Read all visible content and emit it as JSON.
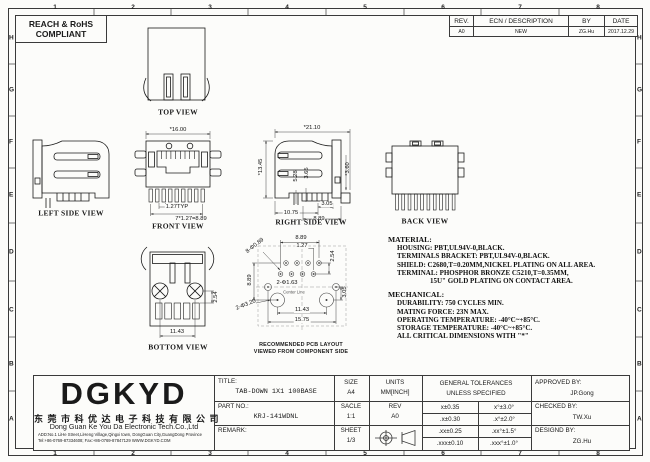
{
  "sheet": {
    "zone_cols": [
      "1",
      "2",
      "3",
      "4",
      "5",
      "6",
      "7",
      "8"
    ],
    "zone_rows": [
      "H",
      "G",
      "F",
      "E",
      "D",
      "C",
      "B",
      "A"
    ],
    "compliance_line1": "REACH & RoHS",
    "compliance_line2": "COMPLIANT"
  },
  "revision_table": {
    "col_rev": "REV.",
    "col_ecn": "ECN / DESCRIPTION",
    "col_by": "BY",
    "col_date": "DATE",
    "rev": "A0",
    "ecn": "NEW",
    "by": "ZG.Hu",
    "date": "2017.12.29"
  },
  "views": {
    "top_label": "TOP VIEW",
    "left_label": "LEFT SIDE VIEW",
    "front_label": "FRONT VIEW",
    "right_label": "RIGHT SIDE VIEW",
    "back_label": "BACK VIEW",
    "bottom_label": "BOTTOM VIEW",
    "pcb_caption1": "RECOMMENDED PCB LAYOUT",
    "pcb_caption2": "VIEWED FROM COMPONENT SIDE",
    "pcb_center_note": "Center Line"
  },
  "dims": {
    "front_width": "*16.00",
    "front_pitch": "1.27TYP",
    "front_total": "7*1.27=8.89",
    "right_width": "*21.10",
    "right_height": "*13.45",
    "right_a": "5.28",
    "right_b": "3.65",
    "right_c": "*3.60",
    "right_d": "3.05",
    "right_e": "10.75",
    "right_f": "8.89",
    "bottom_a": "2.54",
    "bottom_b": "11.43",
    "pcb_top": "8.89",
    "pcb_pitch": "1.27",
    "pcb_row": "2.54",
    "pcb_left": "8.89",
    "pcb_pin_holes": "8-Φ0.89",
    "pcb_mid_holes": "2-Φ1.63",
    "pcb_mid_offset": "3.05",
    "pcb_big_holes": "2-Φ3.20",
    "pcb_span_posts": "11.43",
    "pcb_span_holes": "15.75"
  },
  "notes": {
    "material_title": "MATERIAL:",
    "material_lines": [
      "HOUSING: PBT,UL94V-0,BLACK.",
      "TERMINALS BRACKET: PBT,UL94V-0,BLACK.",
      "SHIELD: C2680,T=0.20MM,NICKEL PLATING ON ALL AREA.",
      "TERMINAL: PHOSPHOR BRONZE C5210,T=0.35MM,",
      "15U\" GOLD PLATING ON CONTACT AREA."
    ],
    "mechanical_title": "MECHANICAL:",
    "mechanical_lines": [
      "DURABILITY: 750 CYCLES MIN.",
      "MATING FORCE: 23N MAX.",
      "OPERATING TEMPERATURE: -40°C~+85°C.",
      "STORAGE TEMPERATURE: -40°C~+85°C.",
      "ALL CRITICAL DIMENSIONS WITH \"*\""
    ]
  },
  "title_block": {
    "logo": "DGKYD",
    "company_cn": "东 莞 市 科 优 达 电 子 科 技 有 限 公 司",
    "company_en": "Dong Guan Ke You Da Electronic Tech.Co.,Ltd",
    "address": "ADD:No.1 LiHe Street,LiHeng Village,Qingxi town, DongGuan City,GuangDong Province",
    "contact": "Tel:+86-0769-87334608; Fax:+86-0769-87847129 WWW.DGKYD.COM",
    "title_label": "TITLE:",
    "title_value": "TAB-DOWN 1X1 100BASE",
    "part_label": "PART NO.:",
    "part_value": "KRJ-141WDNL",
    "remark_label": "REMARK:",
    "size_label": "SIZE",
    "size_value": "A4",
    "units_label": "UNITS",
    "units_value": "MM[INCH]",
    "scale_label": "SACLE",
    "scale_value": "1:1",
    "rev_label": "REV",
    "rev_value": "A0",
    "sheet_label": "SHEET",
    "sheet_value": "1/3",
    "tol_header1": "GENERAL TOLERANCES",
    "tol_header2": "UNLESS SPECIFIED",
    "tolerances": [
      [
        "x±0.35",
        "x°±3.0°"
      ],
      [
        ".x±0.30",
        ".x°±2.0°"
      ],
      [
        ".xx±0.25",
        ".xx°±1.5°"
      ],
      [
        ".xxx±0.10",
        ".xxx°±1.0°"
      ]
    ],
    "approved_label": "APPROVED BY:",
    "approved_value": "JP.Gong",
    "checked_label": "CHECKED BY:",
    "checked_value": "TW.Xu",
    "designed_label": "DESIGND BY:",
    "designed_value": "ZG.Hu"
  }
}
